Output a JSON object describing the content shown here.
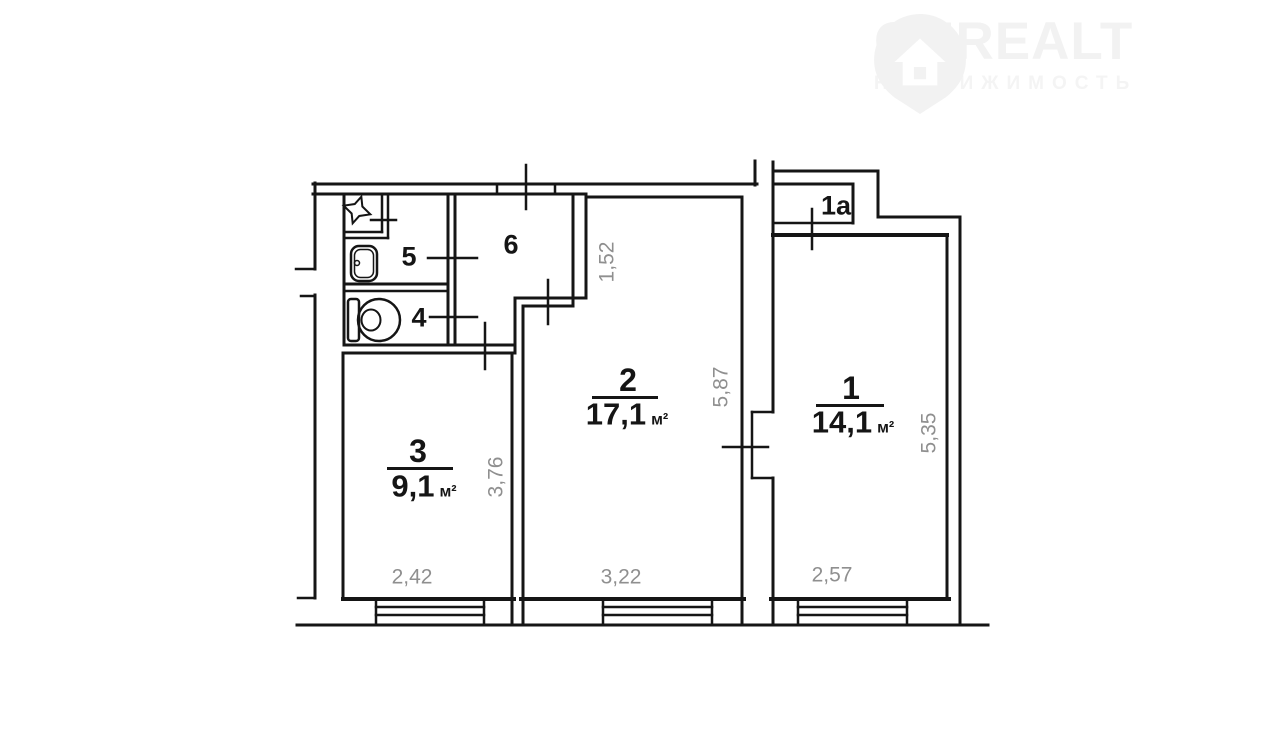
{
  "logo": {
    "brand": "ONREALT",
    "tagline": "НЕДВИЖИМОСТЬ"
  },
  "units": {
    "sqm": "м²"
  },
  "rooms": {
    "r1": {
      "number": "1",
      "area": "14,1"
    },
    "r1a": {
      "number": "1a"
    },
    "r2": {
      "number": "2",
      "area": "17,1"
    },
    "r3": {
      "number": "3",
      "area": "9,1"
    },
    "r4": {
      "number": "4"
    },
    "r5": {
      "number": "5"
    },
    "r6": {
      "number": "6"
    }
  },
  "dimensions": {
    "d152": "1,52",
    "d587": "5,87",
    "d535": "5,35",
    "d376": "3,76",
    "d242": "2,42",
    "d322": "3,22",
    "d257": "2,57"
  }
}
